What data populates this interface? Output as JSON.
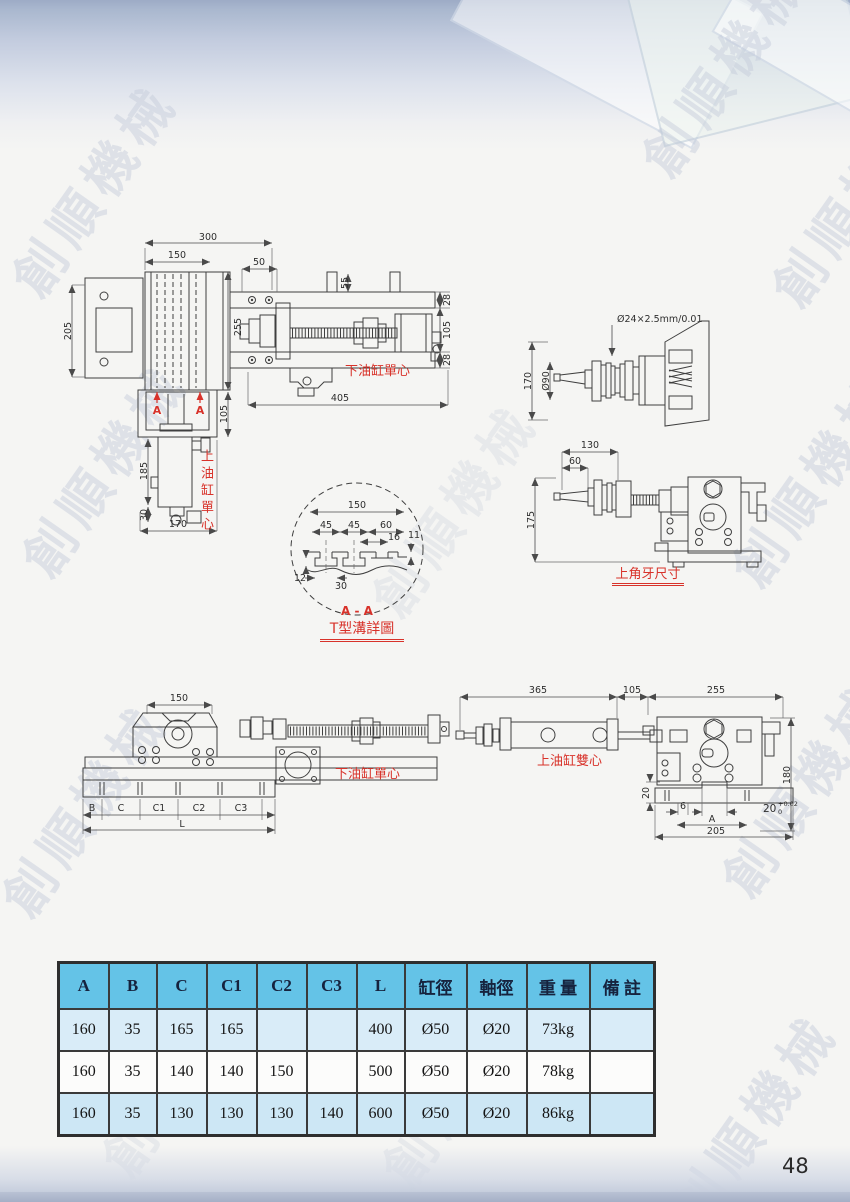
{
  "page": {
    "number": "48",
    "watermark": "創順機械"
  },
  "table": {
    "headers": [
      "A",
      "B",
      "C",
      "C1",
      "C2",
      "C3",
      "L",
      "缸徑",
      "軸徑",
      "重 量",
      "備 註"
    ],
    "rows": [
      [
        "160",
        "35",
        "165",
        "165",
        "",
        "",
        "400",
        "Ø50",
        "Ø20",
        "73kg",
        ""
      ],
      [
        "160",
        "35",
        "140",
        "140",
        "150",
        "",
        "500",
        "Ø50",
        "Ø20",
        "78kg",
        ""
      ],
      [
        "160",
        "35",
        "130",
        "130",
        "130",
        "140",
        "600",
        "Ø50",
        "Ø20",
        "86kg",
        ""
      ]
    ]
  },
  "drawings": {
    "front": {
      "d300": "300",
      "d150": "150",
      "d50": "50",
      "d55": "55",
      "d205": "205",
      "d255": "255",
      "d28a": "28",
      "d105r": "105",
      "d28b": "28",
      "d405": "405",
      "d105b": "105",
      "d185": "185",
      "d30": "30",
      "d170": "170",
      "sectionA": "A",
      "label_lower": "下油缸單心",
      "label_upper": "上油缸單心"
    },
    "slot_detail": {
      "d150": "150",
      "d45a": "45",
      "d45b": "45",
      "d60": "60",
      "d16": "16",
      "d11": "11",
      "d12": "12",
      "d30": "30",
      "section": "A - A",
      "caption": "T型溝詳圖"
    },
    "handwheel": {
      "callout": "Ø24×2.5mm/0.01",
      "d90": "Ø90",
      "d170": "170"
    },
    "upper_side": {
      "d130": "130",
      "d60": "60",
      "d175": "175",
      "caption": "上角牙尺寸"
    },
    "lower_side": {
      "d150": "150",
      "dB": "B",
      "dC": "C",
      "dC1": "C1",
      "dC2": "C2",
      "dC3": "C3",
      "dL": "L",
      "label": "下油缸單心"
    },
    "upper_top": {
      "d365": "365",
      "d105": "105",
      "d255": "255",
      "d180": "180",
      "d20": "20",
      "d6": "6",
      "dA": "A",
      "d205": "205",
      "tol_base": "20",
      "tol_top": "+0.02",
      "tol_bottom": "0",
      "label": "上油缸雙心"
    }
  }
}
